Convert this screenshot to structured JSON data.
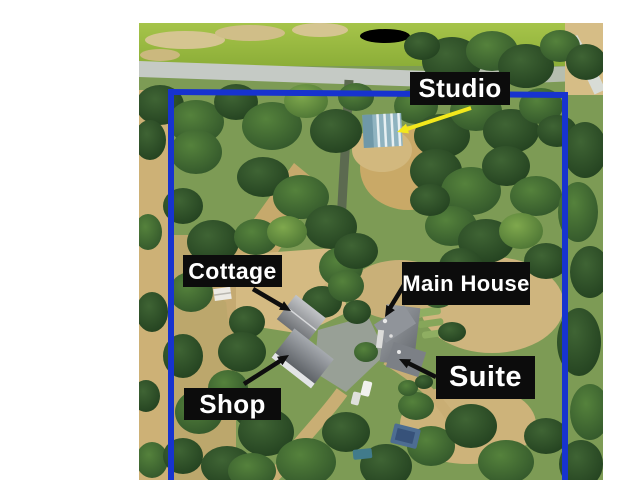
{
  "page": {
    "background_color": "#ffffff"
  },
  "annotations": {
    "boundary_color": "#1733cf",
    "label_background": "#0c0c0c",
    "label_text_color": "#ffffff",
    "highlight_arrow_color": "#f2e81c",
    "arrow_color": "#0e0e0e",
    "labels": [
      {
        "id": "studio",
        "text": "Studio"
      },
      {
        "id": "cottage",
        "text": "Cottage"
      },
      {
        "id": "main_house",
        "text": "Main House"
      },
      {
        "id": "shop",
        "text": "Shop"
      },
      {
        "id": "suite",
        "text": "Suite"
      }
    ]
  }
}
